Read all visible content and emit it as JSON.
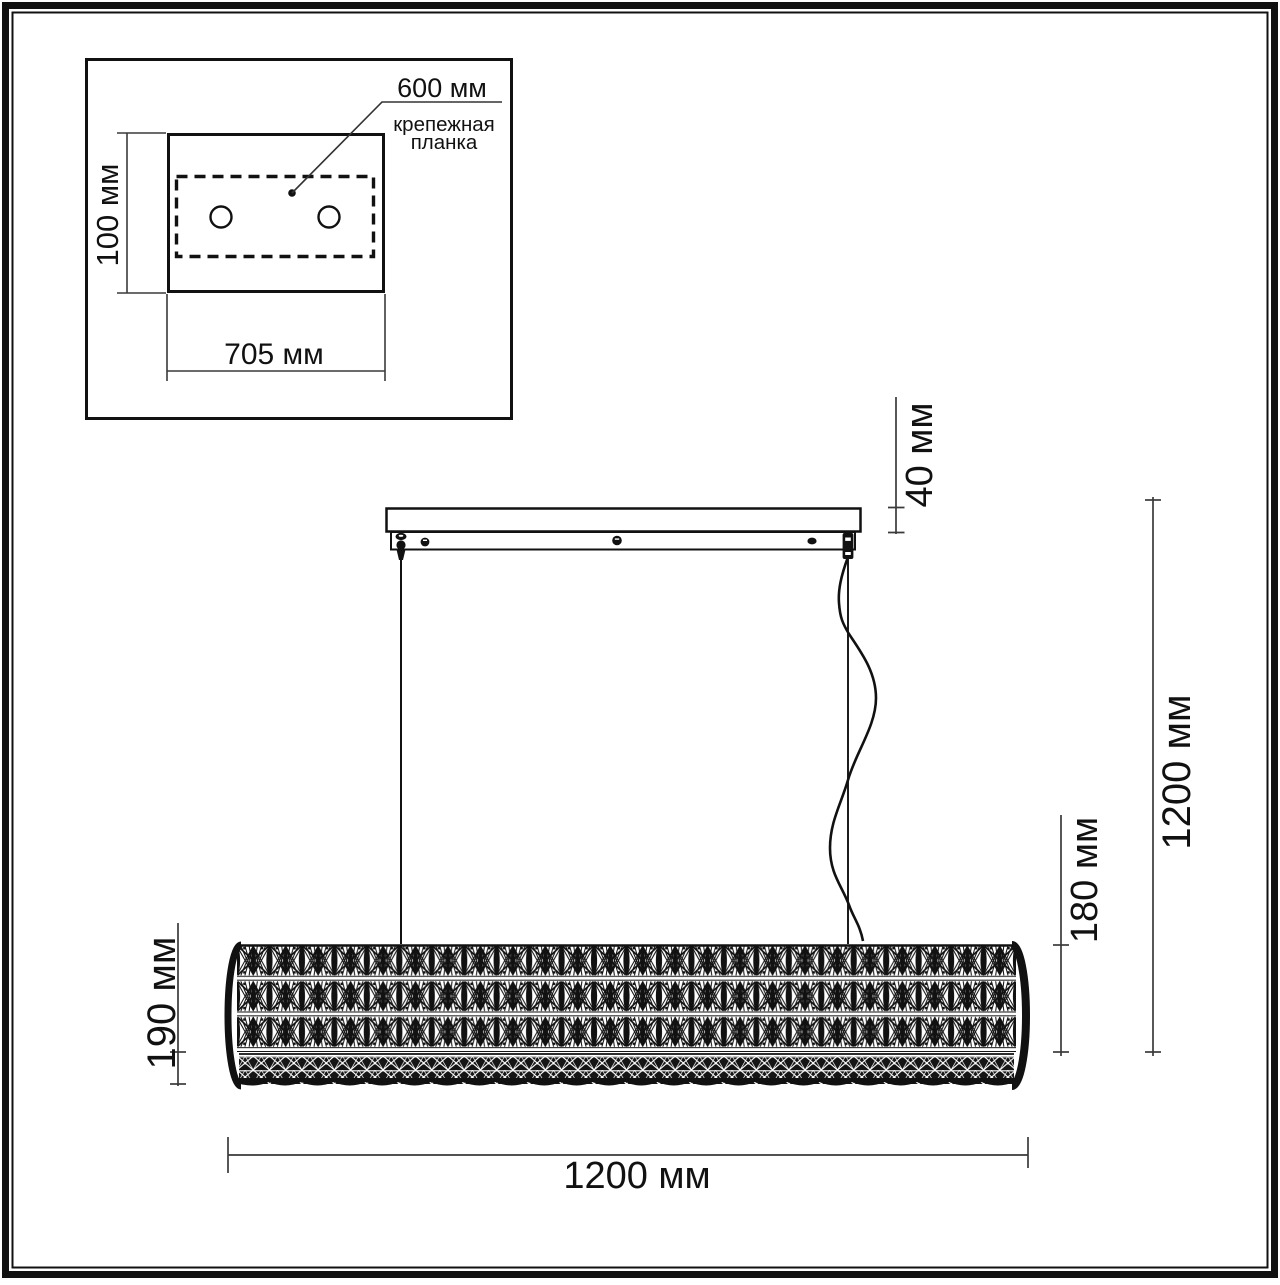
{
  "colors": {
    "ink": "#111111",
    "dim_line": "#3a3a3a",
    "background": "#ffffff"
  },
  "inset": {
    "leader_label": "600 мм",
    "mount_plate_label_line1": "крепежная",
    "mount_plate_label_line2": "планка",
    "height_label": "100 мм",
    "width_label": "705 мм"
  },
  "main": {
    "canopy_height_label": "40 мм",
    "drop_height_label": "1200 мм",
    "shade_height_label": "180 мм",
    "shade_full_height_label": "190 мм",
    "width_label": "1200 мм"
  }
}
